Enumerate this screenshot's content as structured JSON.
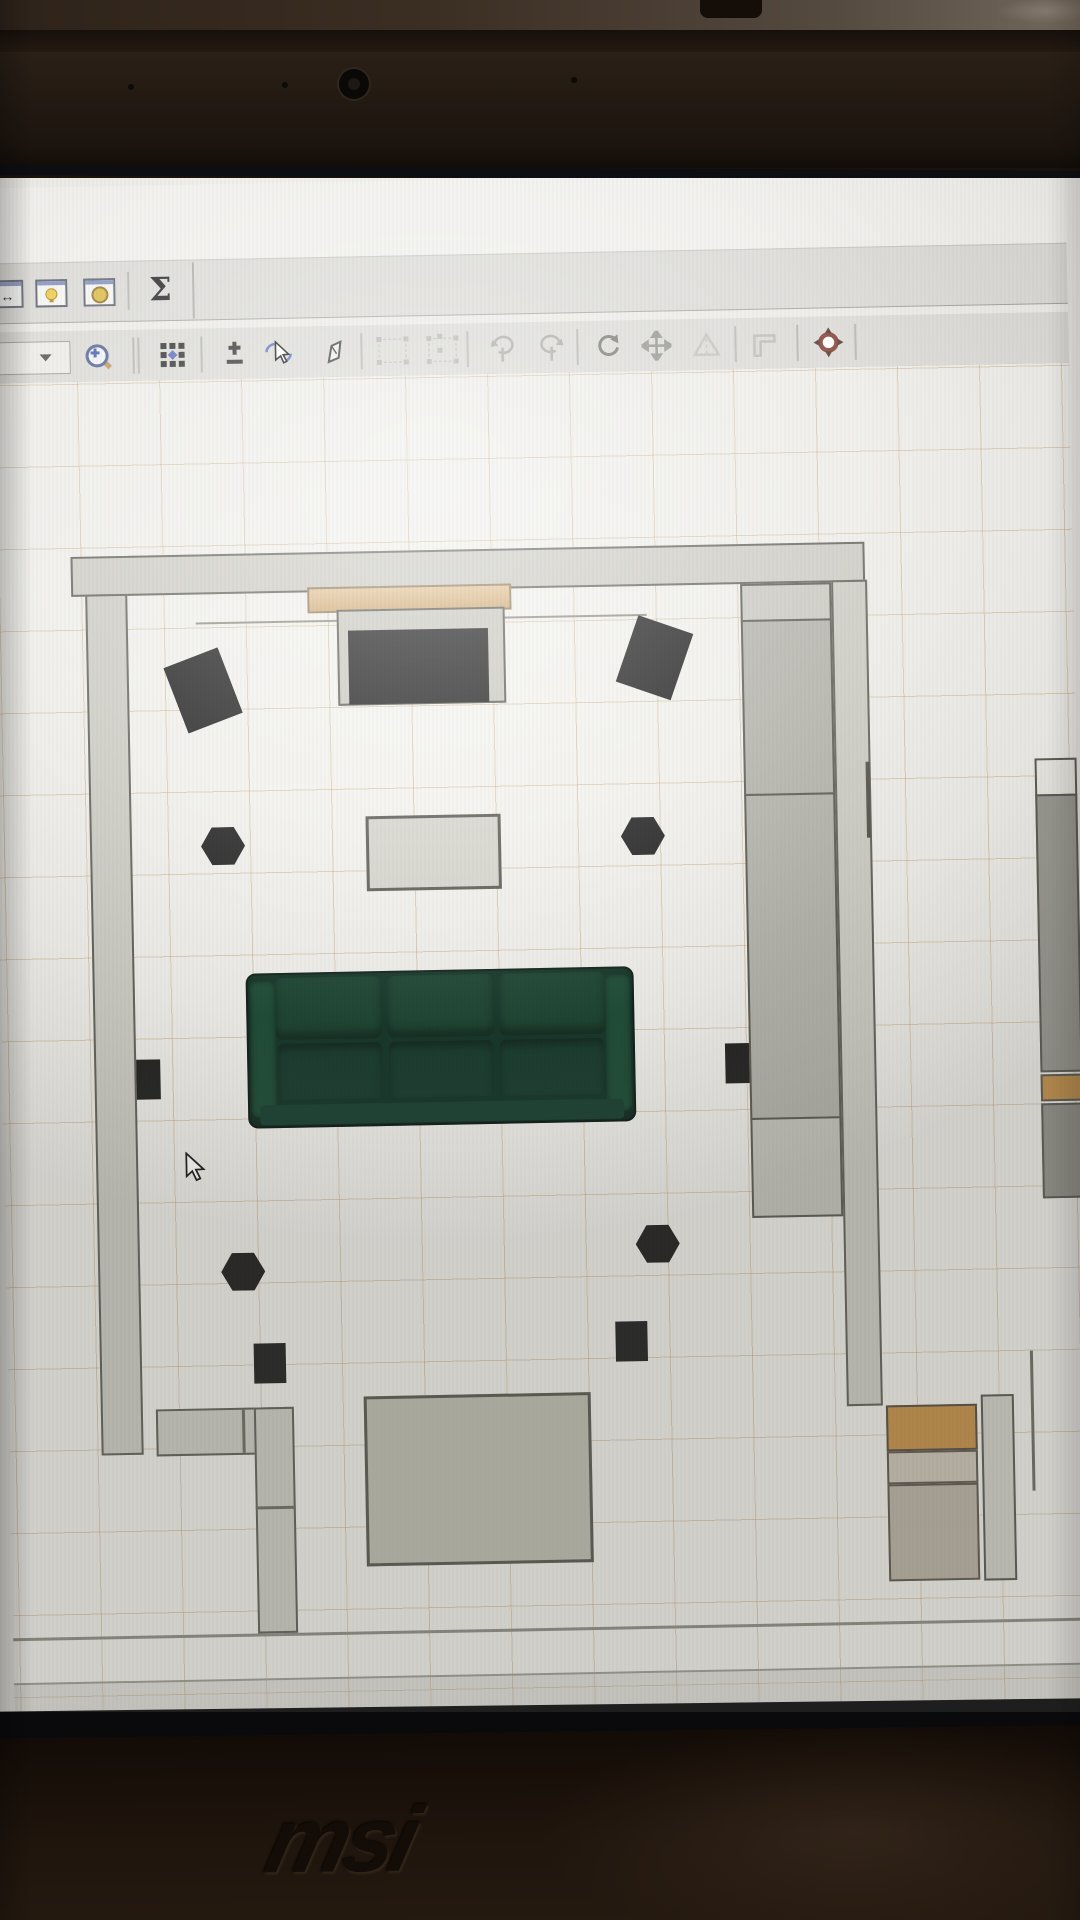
{
  "device": {
    "brand": "msi",
    "body_color": "#1d130c",
    "bezel_color": "#241a13",
    "webcam": {
      "x": 352,
      "y": 82,
      "d": 30
    },
    "bezel_dots": [
      [
        131,
        87
      ],
      [
        285,
        85
      ],
      [
        574,
        80
      ]
    ]
  },
  "app": {
    "toolbar_row1": {
      "buttons": [
        {
          "name": "dimensions-window-button",
          "enabled": true
        },
        {
          "name": "lightbulb-window-button",
          "enabled": true
        },
        {
          "name": "coin-window-button",
          "enabled": true
        },
        {
          "name": "sum-button",
          "glyph": "Σ",
          "enabled": true
        }
      ]
    },
    "toolbar_row2": {
      "zoom_select_value": "",
      "buttons": [
        {
          "name": "zoom-in-button",
          "enabled": true
        },
        {
          "name": "pattern-grid-button",
          "enabled": true
        },
        {
          "name": "add-point-button",
          "enabled": true
        },
        {
          "name": "select-rotate-button",
          "enabled": true
        },
        {
          "name": "draw-pen-button",
          "enabled": true
        },
        {
          "name": "group-select-button",
          "enabled": false
        },
        {
          "name": "group-select-plus-button",
          "enabled": false
        },
        {
          "name": "rotate-pin-left-button",
          "enabled": false
        },
        {
          "name": "rotate-pin-right-button",
          "enabled": false
        },
        {
          "name": "rotate-button",
          "enabled": true
        },
        {
          "name": "move-button",
          "enabled": true
        },
        {
          "name": "flip-button",
          "enabled": false
        },
        {
          "name": "corner-flag-button",
          "enabled": false
        },
        {
          "name": "target-origin-button",
          "enabled": true
        }
      ]
    },
    "canvas": {
      "grid_spacing": 82,
      "grid_color": "rgba(186,148,92,0.40)",
      "grid_offset_x": 6,
      "grid_offset_y": 24,
      "background": "#edece8",
      "cursor": {
        "x": 178,
        "y": 772
      },
      "plan_items": [
        {
          "name": "curtain-rail-line",
          "shape": "line",
          "x": 202,
          "y": 243,
          "w": 451,
          "h": 2,
          "fill": "#8a897f"
        },
        {
          "name": "wall-top",
          "shape": "rect",
          "x": 78,
          "y": 175,
          "w": 794,
          "h": 40,
          "fill": "#cac9c1",
          "border": "2px solid #5d5c55"
        },
        {
          "name": "wall-left",
          "shape": "rect",
          "x": 92,
          "y": 213,
          "w": 42,
          "h": 861,
          "fill": "#cac9c1",
          "border": "2px solid #5d5c55"
        },
        {
          "name": "wall-right",
          "shape": "rect",
          "x": 838,
          "y": 213,
          "w": 36,
          "h": 826,
          "fill": "#cac9c1",
          "border": "2px solid #5d5c55"
        },
        {
          "name": "wall-bottom-left-horizontal",
          "shape": "rect",
          "x": 147,
          "y": 1029,
          "w": 133,
          "h": 47,
          "fill": "#cac9c1",
          "border": "2px solid #5d5c55"
        },
        {
          "name": "wall-bottom-left-vertical",
          "shape": "rect",
          "x": 245,
          "y": 1029,
          "w": 40,
          "h": 226,
          "fill": "#cac9c1",
          "border": "2px solid #5d5c55"
        },
        {
          "name": "wall-joint-line",
          "shape": "line",
          "x": 233,
          "y": 1031,
          "w": 3,
          "h": 43,
          "fill": "#6b6a60"
        },
        {
          "name": "wall-joint-line-2",
          "shape": "line",
          "x": 245,
          "y": 1128,
          "w": 40,
          "h": 3,
          "fill": "#6b6a60"
        },
        {
          "name": "wardrobe-section-top",
          "shape": "rect",
          "x": 747,
          "y": 215,
          "w": 91,
          "h": 38,
          "fill": "#c7c6be",
          "border": "2px solid #55544d"
        },
        {
          "name": "wardrobe-section-2",
          "shape": "rect",
          "x": 747,
          "y": 251,
          "w": 91,
          "h": 176,
          "fill": "#b0afa7",
          "border": "2px solid #55544d"
        },
        {
          "name": "wardrobe-section-3",
          "shape": "rect",
          "x": 747,
          "y": 425,
          "w": 91,
          "h": 326,
          "fill": "#b0afa7",
          "border": "2px solid #55544d"
        },
        {
          "name": "wardrobe-section-bottom",
          "shape": "rect",
          "x": 747,
          "y": 749,
          "w": 91,
          "h": 100,
          "fill": "#c2c1b9",
          "border": "2px solid #55544d"
        },
        {
          "name": "door-line-right-wall",
          "shape": "line",
          "x": 869,
          "y": 395,
          "w": 4,
          "h": 76,
          "fill": "#4c4c45"
        },
        {
          "name": "tv-shelf",
          "shape": "rect",
          "x": 314,
          "y": 210,
          "w": 204,
          "h": 26,
          "fill": "linear-gradient(180deg,#e3c193,#cda76e)",
          "border": "2px solid #8f7752"
        },
        {
          "name": "tv-stand",
          "shape": "rect",
          "x": 343,
          "y": 233,
          "w": 168,
          "h": 96,
          "fill": "#c7c6be",
          "border": "2px solid #55544d"
        },
        {
          "name": "tv",
          "shape": "rect",
          "x": 354,
          "y": 254,
          "w": 140,
          "h": 74,
          "fill": "#121212"
        },
        {
          "name": "speaker-front-left",
          "shape": "rect",
          "x": 179,
          "y": 276,
          "w": 58,
          "h": 70,
          "rot": -20,
          "fill": "#151515"
        },
        {
          "name": "speaker-front-right",
          "shape": "rect",
          "x": 631,
          "y": 252,
          "w": 58,
          "h": 70,
          "rot": 20,
          "fill": "#151515"
        },
        {
          "name": "hex-marker-upper-left",
          "shape": "hex",
          "x": 203,
          "y": 447,
          "w": 44,
          "h": 40,
          "fill": "#181818"
        },
        {
          "name": "hex-marker-upper-right",
          "shape": "hex",
          "x": 623,
          "y": 445,
          "w": 44,
          "h": 40,
          "fill": "#181818"
        },
        {
          "name": "coffee-table",
          "shape": "rect",
          "x": 368,
          "y": 440,
          "w": 135,
          "h": 75,
          "fill": "#d3d2ca",
          "border": "3px solid #55544d"
        },
        {
          "name": "sofa",
          "shape": "sofa",
          "x": 245,
          "y": 595,
          "w": 388,
          "h": 155
        },
        {
          "name": "wall-speaker-left",
          "shape": "rect",
          "x": 134,
          "y": 679,
          "w": 24,
          "h": 40,
          "fill": "#1b1b1b"
        },
        {
          "name": "wall-speaker-right",
          "shape": "rect",
          "x": 723,
          "y": 674,
          "w": 24,
          "h": 40,
          "fill": "#1b1b1b"
        },
        {
          "name": "hex-marker-lower-left",
          "shape": "hex",
          "x": 215,
          "y": 873,
          "w": 44,
          "h": 40,
          "fill": "#181818"
        },
        {
          "name": "hex-marker-lower-right",
          "shape": "hex",
          "x": 630,
          "y": 853,
          "w": 44,
          "h": 40,
          "fill": "#181818"
        },
        {
          "name": "floor-marker-left",
          "shape": "rect",
          "x": 246,
          "y": 965,
          "w": 32,
          "h": 40,
          "fill": "#1b1b1b"
        },
        {
          "name": "floor-marker-right",
          "shape": "rect",
          "x": 608,
          "y": 950,
          "w": 32,
          "h": 40,
          "fill": "#1b1b1b"
        },
        {
          "name": "bottom-table",
          "shape": "rect",
          "x": 355,
          "y": 1020,
          "w": 227,
          "h": 170,
          "fill": "#bcbbae",
          "border": "3px solid #55544d"
        },
        {
          "name": "right-column-cap",
          "shape": "rect",
          "x": 1038,
          "y": 395,
          "w": 42,
          "h": 38,
          "fill": "#e7e6e0",
          "border": "2px solid #55544d"
        },
        {
          "name": "right-column-upper",
          "shape": "rect",
          "x": 1038,
          "y": 431,
          "w": 42,
          "h": 278,
          "fill": "#96958d",
          "border": "2px solid #55544d"
        },
        {
          "name": "right-column-wood-strip",
          "shape": "rect",
          "x": 1038,
          "y": 711,
          "w": 42,
          "h": 27,
          "fill": "#c18d45",
          "border": "2px solid #55544d"
        },
        {
          "name": "right-column-lower",
          "shape": "rect",
          "x": 1038,
          "y": 740,
          "w": 42,
          "h": 95,
          "fill": "#8f8e86",
          "border": "2px solid #55544d"
        },
        {
          "name": "cabinet-bottom-right-wood-top",
          "shape": "rect",
          "x": 877,
          "y": 1039,
          "w": 91,
          "h": 46,
          "fill": "#c18d45",
          "border": "2px solid #50493c"
        },
        {
          "name": "cabinet-bottom-right-middle",
          "shape": "rect",
          "x": 877,
          "y": 1085,
          "w": 91,
          "h": 33,
          "fill": "#c7c0b3",
          "border": "2px solid #5a544a"
        },
        {
          "name": "cabinet-bottom-right-body",
          "shape": "rect",
          "x": 877,
          "y": 1118,
          "w": 91,
          "h": 97,
          "fill": "#b6aea0",
          "border": "2px solid #5a544a"
        },
        {
          "name": "cabinet-bottom-right-side-bar",
          "shape": "rect",
          "x": 972,
          "y": 1030,
          "w": 33,
          "h": 186,
          "fill": "#cecdc5",
          "border": "2px solid #55544d"
        },
        {
          "name": "wall-line-far-right",
          "shape": "line",
          "x": 1022,
          "y": 987,
          "w": 3,
          "h": 140,
          "fill": "#6b6a60"
        },
        {
          "name": "plan-bottom-line-1",
          "shape": "line",
          "x": 0,
          "y": 1255,
          "w": 1080,
          "h": 3,
          "fill": "#8b8a80"
        },
        {
          "name": "plan-bottom-line-2",
          "shape": "line",
          "x": 0,
          "y": 1300,
          "w": 1080,
          "h": 2,
          "fill": "#9b9a91"
        },
        {
          "name": "plan-bottom-band",
          "shape": "line",
          "x": 0,
          "y": 1302,
          "w": 1080,
          "h": 37,
          "fill": "rgba(176,174,166,0.28)"
        }
      ]
    }
  }
}
